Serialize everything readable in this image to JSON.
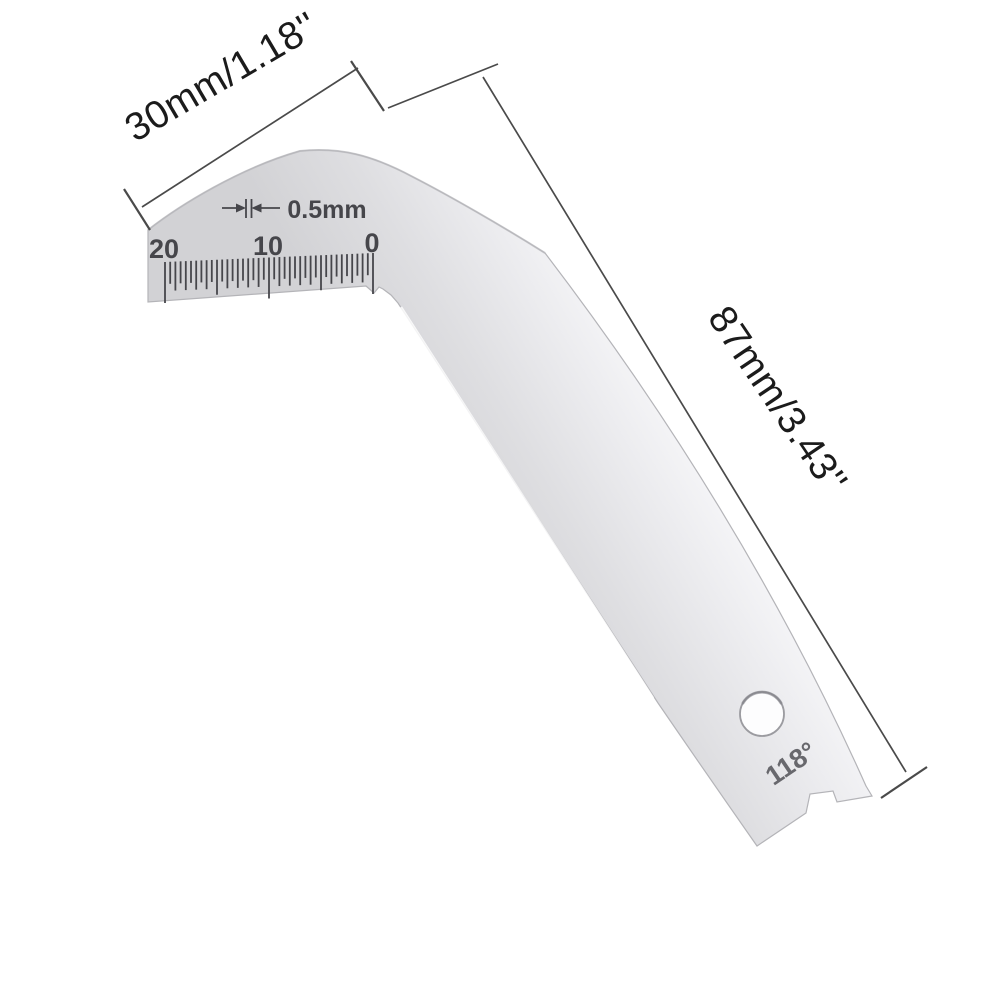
{
  "photo": {
    "background": "#ffffff",
    "gauge": {
      "body_gradient": [
        "#d2d2d5",
        "#dedee1",
        "#ebebee",
        "#f8f8fa",
        "#ffffff"
      ],
      "outline_color": "#b4b4b8",
      "engraving_color": "#46464b",
      "markings": {
        "angle_label": "118°",
        "resolution_label": "0.5mm",
        "scale_labels": [
          {
            "text": "20",
            "x": 164,
            "baseline_y": 258
          },
          {
            "text": "10",
            "x": 268,
            "baseline_y": 255
          },
          {
            "text": "0",
            "x": 372,
            "baseline_y": 252
          }
        ]
      },
      "scale": {
        "range_mm": [
          0,
          20
        ],
        "division_mm": 0.5,
        "x_start": 165,
        "x_end": 373,
        "top_y_start": 262,
        "top_y_end": 253,
        "divisions": 40,
        "major_every": 20,
        "semi_every": 10,
        "medium_every": 2,
        "major_len": 41,
        "semi_len": 35,
        "medium_len": 29,
        "minor_len": 22
      }
    },
    "dimensions": {
      "line_color": "#4a4a4a",
      "label_color": "#1b1b1b",
      "width_label": "30mm/1.18''",
      "length_label": "87mm/3.43''"
    }
  }
}
